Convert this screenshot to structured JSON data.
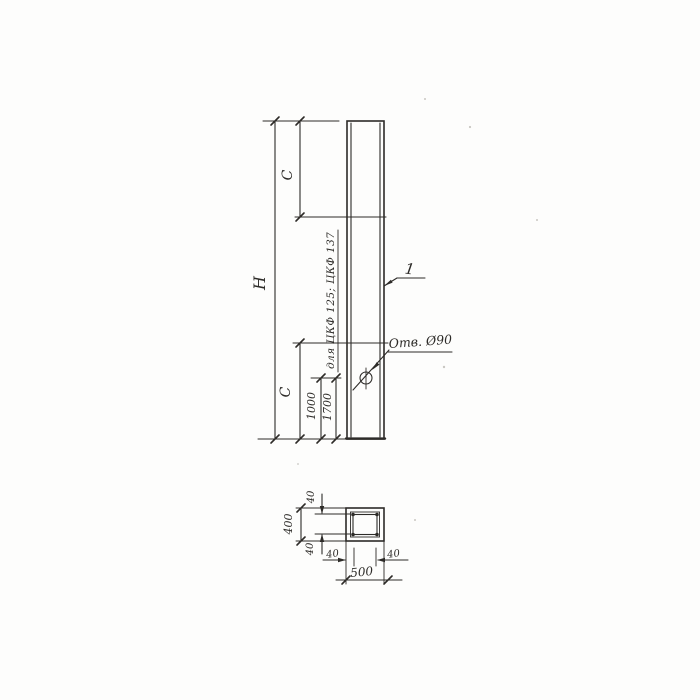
{
  "colors": {
    "ink": "#2d2b28",
    "paper": "#fdfdfc"
  },
  "elevation": {
    "height_label": "H",
    "upper_segment_label": "C",
    "lower_segment_label": "C",
    "hole_offset_a": "1000",
    "hole_offset_b": "1700",
    "variant_note": "для ЦКФ 125; ЦКФ 137",
    "hole_callout": "Отв. Ø90",
    "item_mark": "1"
  },
  "section": {
    "width_total": "500",
    "height_total": "400",
    "cover_top": "40",
    "cover_bottom": "40",
    "cover_left": "40",
    "cover_right": "40"
  }
}
